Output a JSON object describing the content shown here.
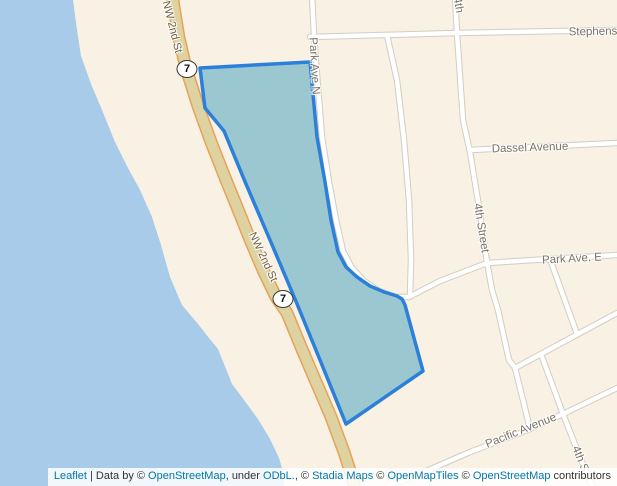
{
  "map": {
    "shield_route": "7",
    "labels": {
      "nw_2nd_st": "NW 2nd St",
      "park_ave_n": "Park Ave N",
      "fourth_top": "4th",
      "fourth_street": "4th Street",
      "dassel_avenue": "Dassel Avenue",
      "park_ave_e": "Park Ave. E",
      "stephens": "Stephens",
      "pacific_avenue": "Pacific Avenue",
      "fourth_s": "4th S"
    },
    "colors": {
      "water": "#a8cbe9",
      "land": "#f8f1e4",
      "selected_polygon_fill": "#9bc7d0",
      "selected_polygon_stroke": "#2d80d9",
      "highway_fill": "#ddd2a0",
      "highway_casing": "#e7a259",
      "road_fill": "#ffffff",
      "road_casing": "#d3cdc3",
      "link_color": "#0078A8"
    }
  },
  "attribution": {
    "leaflet_link": "Leaflet",
    "data_by": " | Data by © ",
    "osm_link_1": "OpenStreetMap",
    "under": ", under ",
    "odbl_link": "ODbL.",
    "comma_c": ", © ",
    "stadia_link": "Stadia Maps",
    "c1": " © ",
    "openmaptiles_link": "OpenMapTiles",
    "c2": " © ",
    "osm_link_2": "OpenStreetMap",
    "contributors": " contributors"
  }
}
